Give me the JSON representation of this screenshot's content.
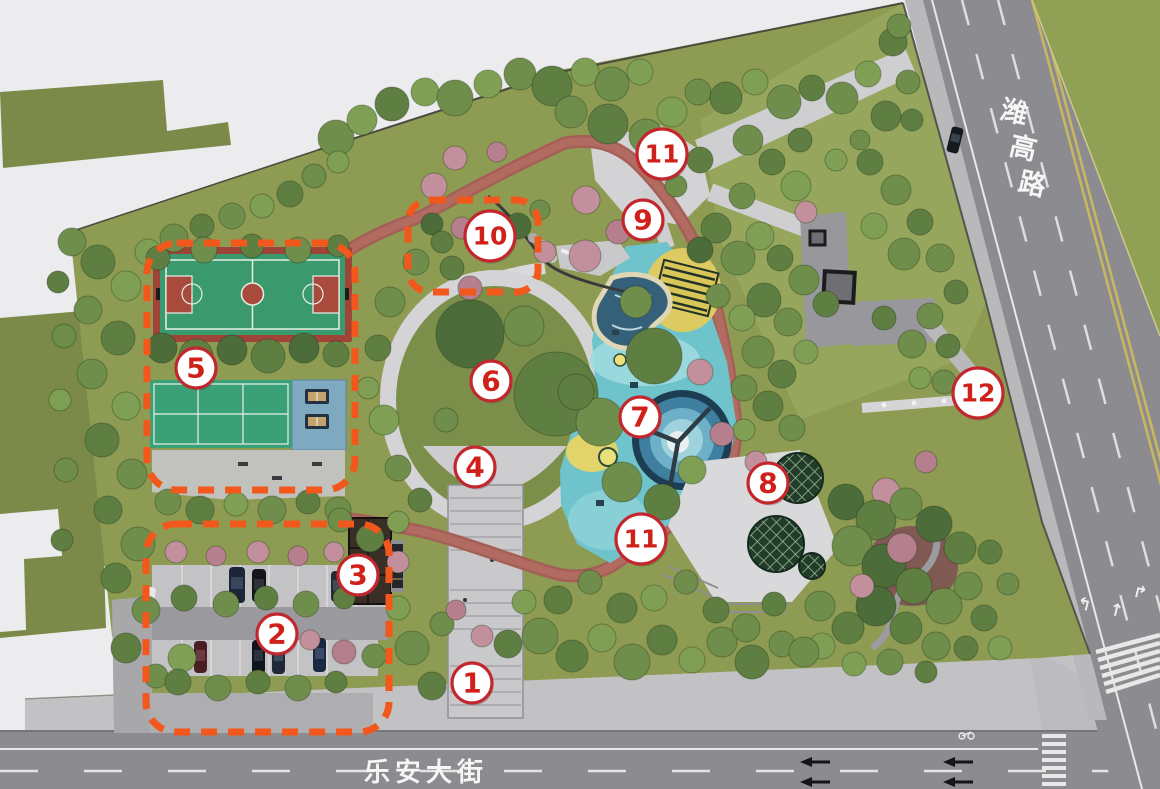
{
  "roads": {
    "east_vertical": "潍高路",
    "south_horizontal": "乐安大街"
  },
  "markers": [
    {
      "label": "1",
      "x": 472,
      "y": 683
    },
    {
      "label": "2",
      "x": 277,
      "y": 634
    },
    {
      "label": "3",
      "x": 358,
      "y": 575
    },
    {
      "label": "4",
      "x": 475,
      "y": 467
    },
    {
      "label": "5",
      "x": 196,
      "y": 368
    },
    {
      "label": "6",
      "x": 491,
      "y": 381
    },
    {
      "label": "7",
      "x": 640,
      "y": 417
    },
    {
      "label": "8",
      "x": 768,
      "y": 483
    },
    {
      "label": "9",
      "x": 643,
      "y": 220
    },
    {
      "label": "10",
      "x": 490,
      "y": 236
    },
    {
      "label": "11",
      "x": 662,
      "y": 154
    },
    {
      "label": "11",
      "x": 641,
      "y": 539
    },
    {
      "label": "12",
      "x": 978,
      "y": 393
    }
  ],
  "zones": [
    {
      "id": "zone-sports-courts",
      "x": 147,
      "y": 243,
      "w": 208,
      "h": 247,
      "r": 30
    },
    {
      "id": "zone-parking",
      "x": 146,
      "y": 524,
      "w": 243,
      "h": 208,
      "r": 30
    },
    {
      "id": "zone-rock-garden",
      "x": 408,
      "y": 200,
      "w": 130,
      "h": 92,
      "r": 22
    }
  ],
  "style": {
    "marker_ring": "#c2272d",
    "marker_fill": "#ffffff",
    "marker_text": "#cf2119",
    "zone_stroke": "#f2571c",
    "track_color": "#a55f57",
    "lawn_color": "#8d9c52",
    "road_color": "#8c8c90"
  }
}
